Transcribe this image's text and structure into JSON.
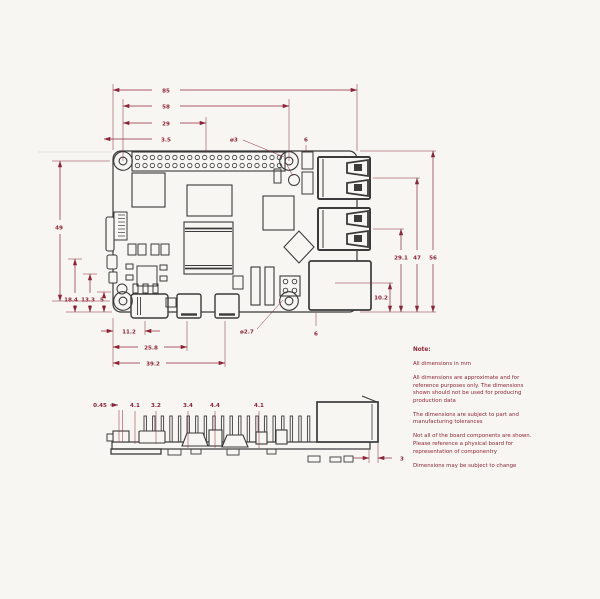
{
  "colors": {
    "background": "#f7f6f3",
    "line": "#3a3a3a",
    "dim": "#8f2438",
    "faint": "#dddad4"
  },
  "top_view": {
    "dims_top": [
      "85",
      "58",
      "29",
      "3.5"
    ],
    "dim_hole_top": "ø3",
    "dim_top_right": "6",
    "dims_right": [
      "29.1",
      "47",
      "56"
    ],
    "dim_right_lower": "10.2",
    "dim_left": "49",
    "dims_left_bottom": [
      "18.4",
      "13.3",
      "5"
    ],
    "dims_bottom": [
      "11.2",
      "25.8",
      "39.2"
    ],
    "dim_hole_bottom": "ø2.7",
    "dim_bottom_right": "6"
  },
  "side_view": {
    "dims_top": [
      "0.45",
      "4.1",
      "3.2",
      "3.4",
      "4.4",
      "4.1"
    ],
    "dim_right": "3"
  },
  "notes": {
    "heading": "Note:",
    "lines": [
      "All dimensions in mm",
      "All dimensions are approximate and for reference purposes only. The dimensions shown should not be used for producing production data",
      "The dimensions are subject to part and manufacturing tolerances",
      "Not all of the board components are shown. Please reference a physical board for representation of componentry",
      "Dimensions may be subject to change"
    ]
  }
}
